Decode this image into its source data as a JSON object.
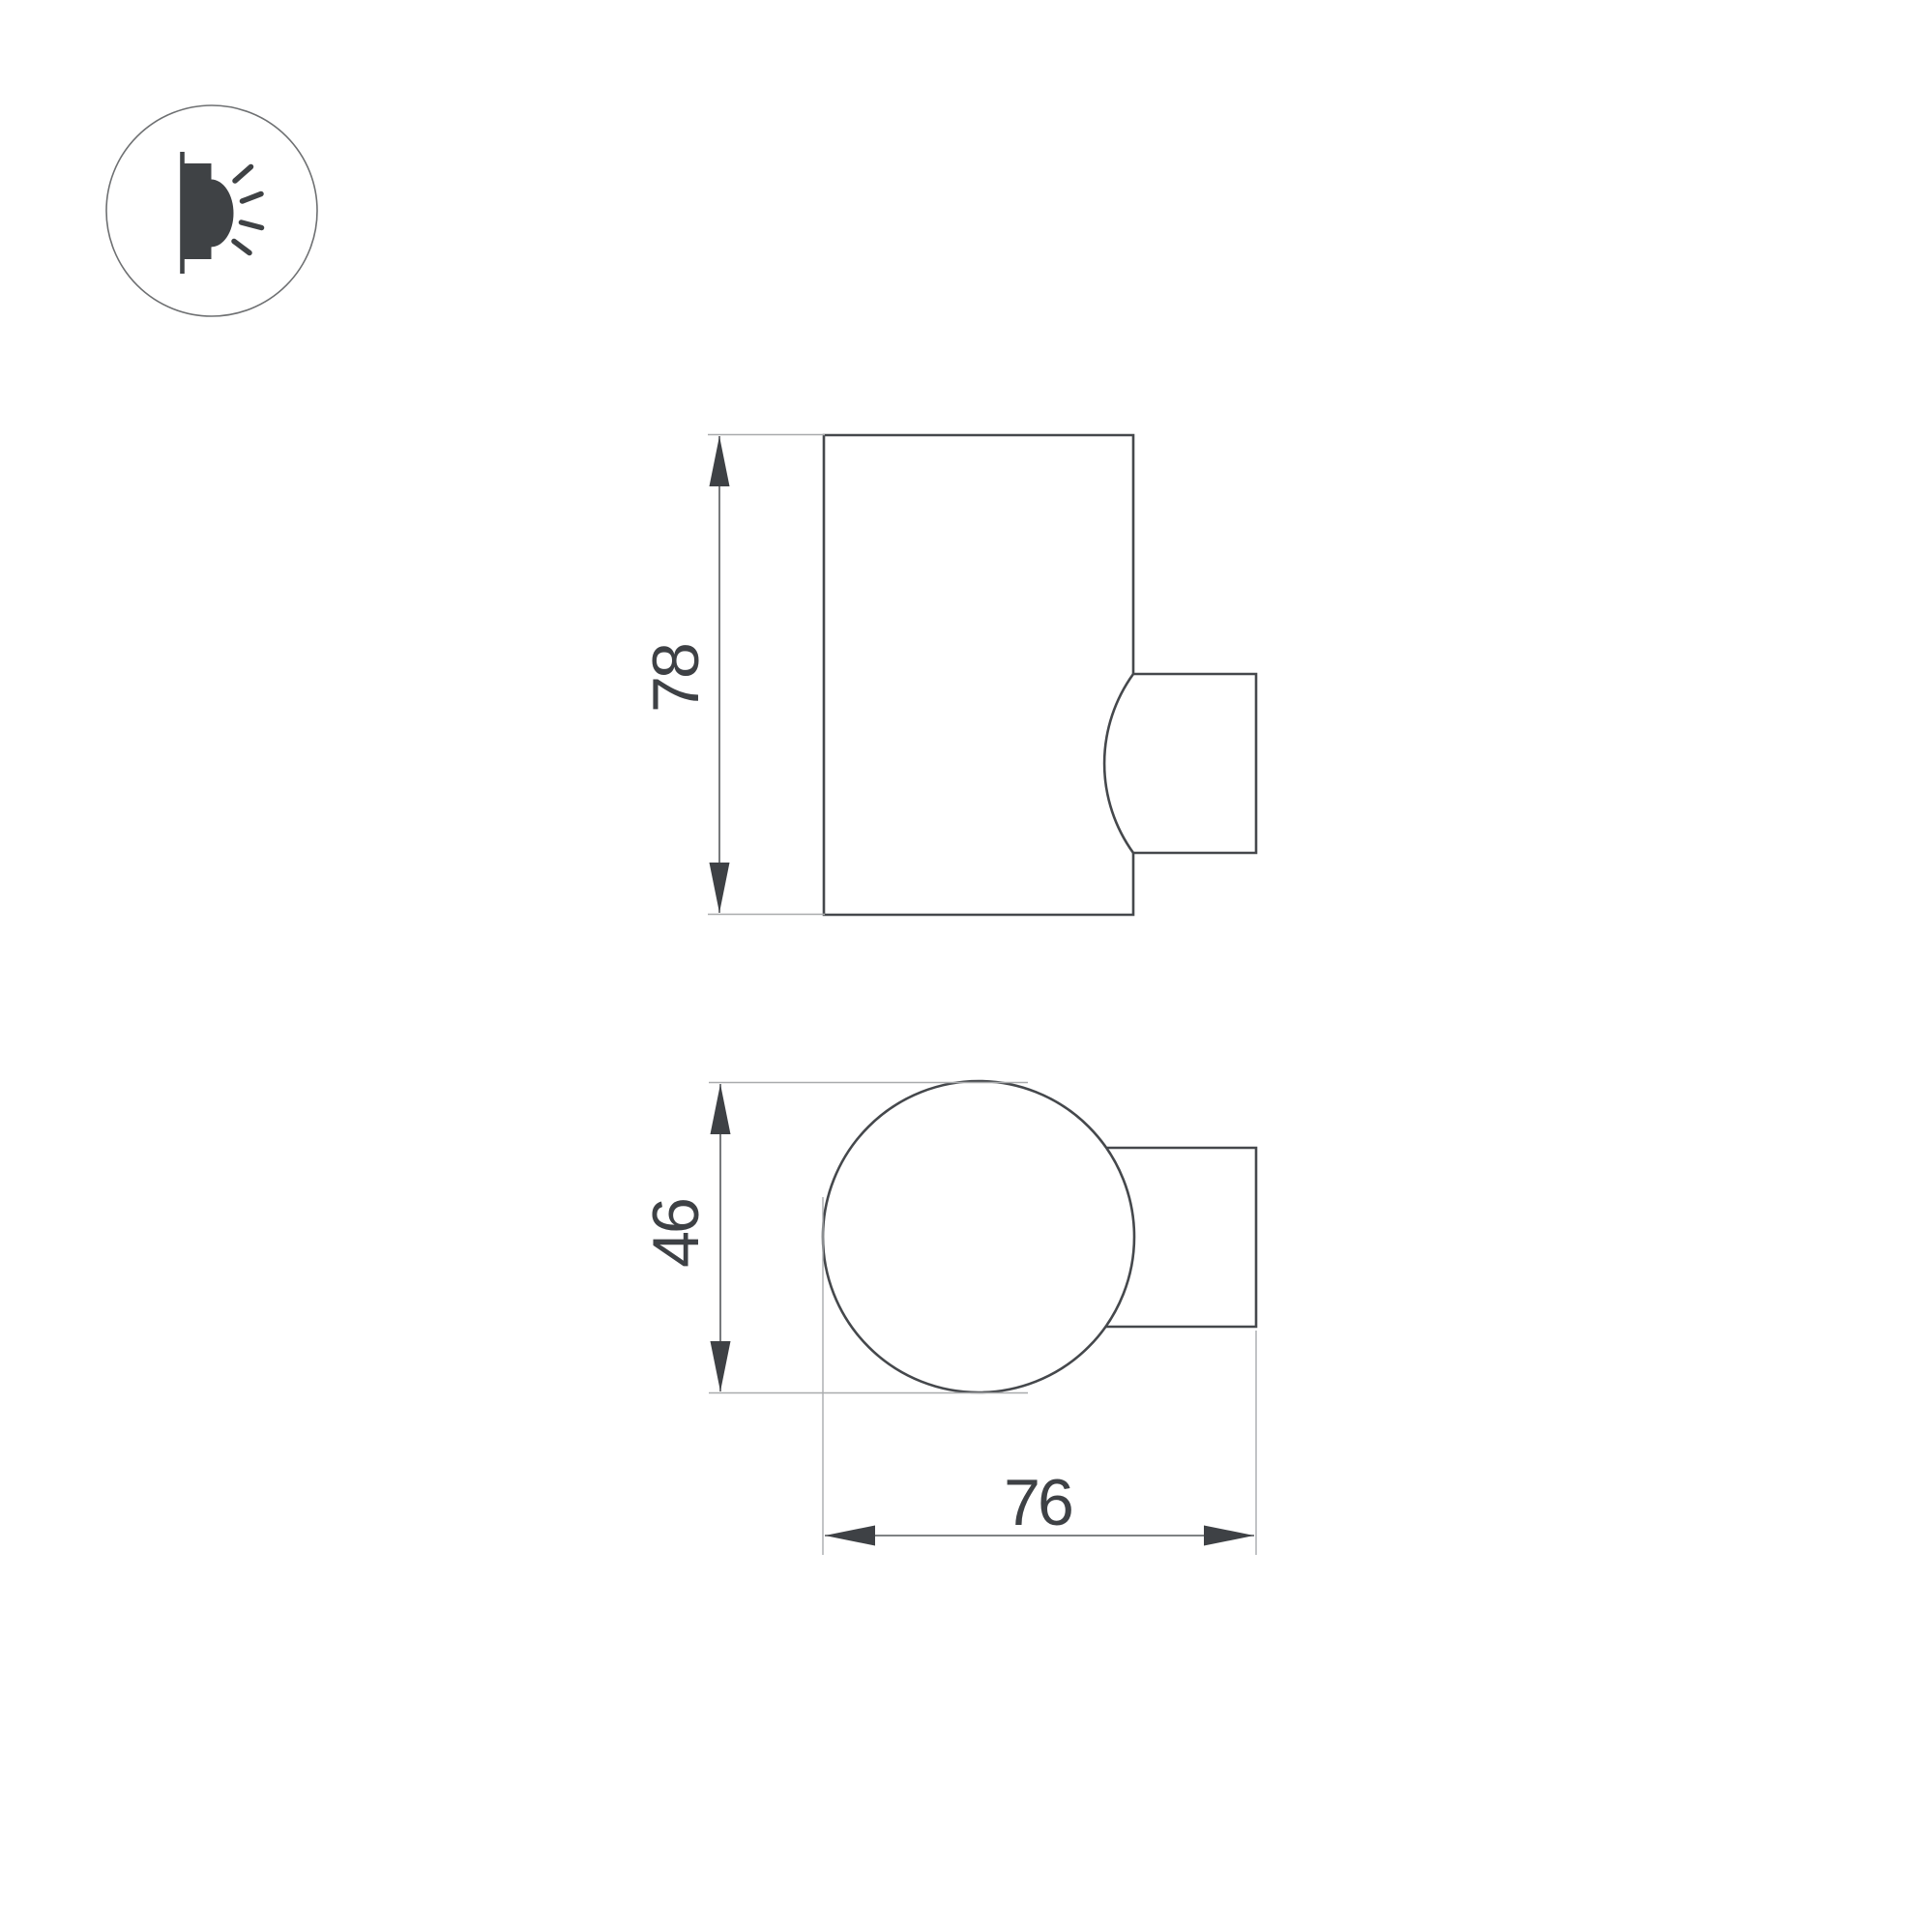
{
  "page": {
    "background": "#ffffff",
    "description": "Technical dimension drawing of a wall-mounted cylindrical luminaire, side view and top view"
  },
  "badge": {
    "icon": "wall-mounted-light-icon"
  },
  "dimensions": {
    "height": "78",
    "diameter": "46",
    "depth": "76"
  },
  "colors": {
    "background": "#ffffff",
    "outline": "#45484c",
    "dimension-line": "#55585c",
    "extension-line": "#a9abad",
    "arrow": "#3e4145",
    "text": "#3e4145",
    "icon": "#3f4245",
    "badge-ring": "#6e7072"
  }
}
